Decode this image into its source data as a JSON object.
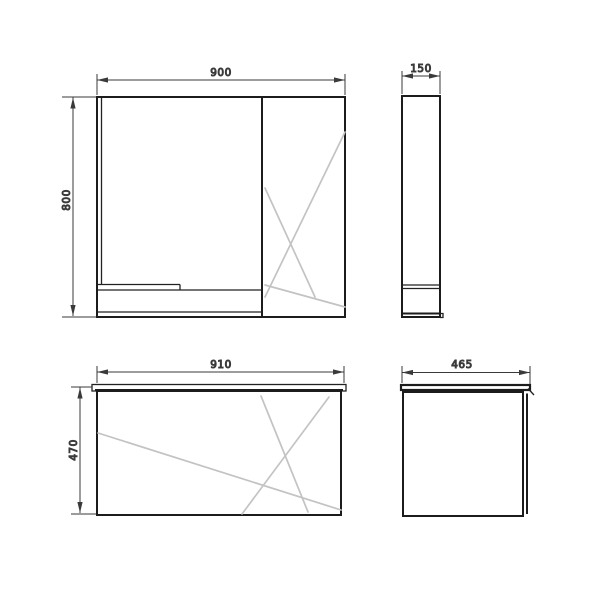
{
  "drawing": {
    "description": "Technical dimension drawing of a bathroom furniture set: mirror cabinet (top views) and vanity unit (bottom views)",
    "background": "#ffffff",
    "colors": {
      "outline": "#1c1c1c",
      "detail": "#222222",
      "dimension": "#3a3a3a",
      "reflection": "#c3c3c3",
      "text": "#3c3c3c"
    },
    "views": {
      "mirror_cabinet_front": {
        "width_mm": "900",
        "height_mm": "800"
      },
      "mirror_cabinet_side": {
        "depth_mm": "150"
      },
      "vanity_front": {
        "width_mm": "910",
        "height_mm": "470"
      },
      "vanity_side": {
        "depth_mm": "465"
      }
    }
  }
}
